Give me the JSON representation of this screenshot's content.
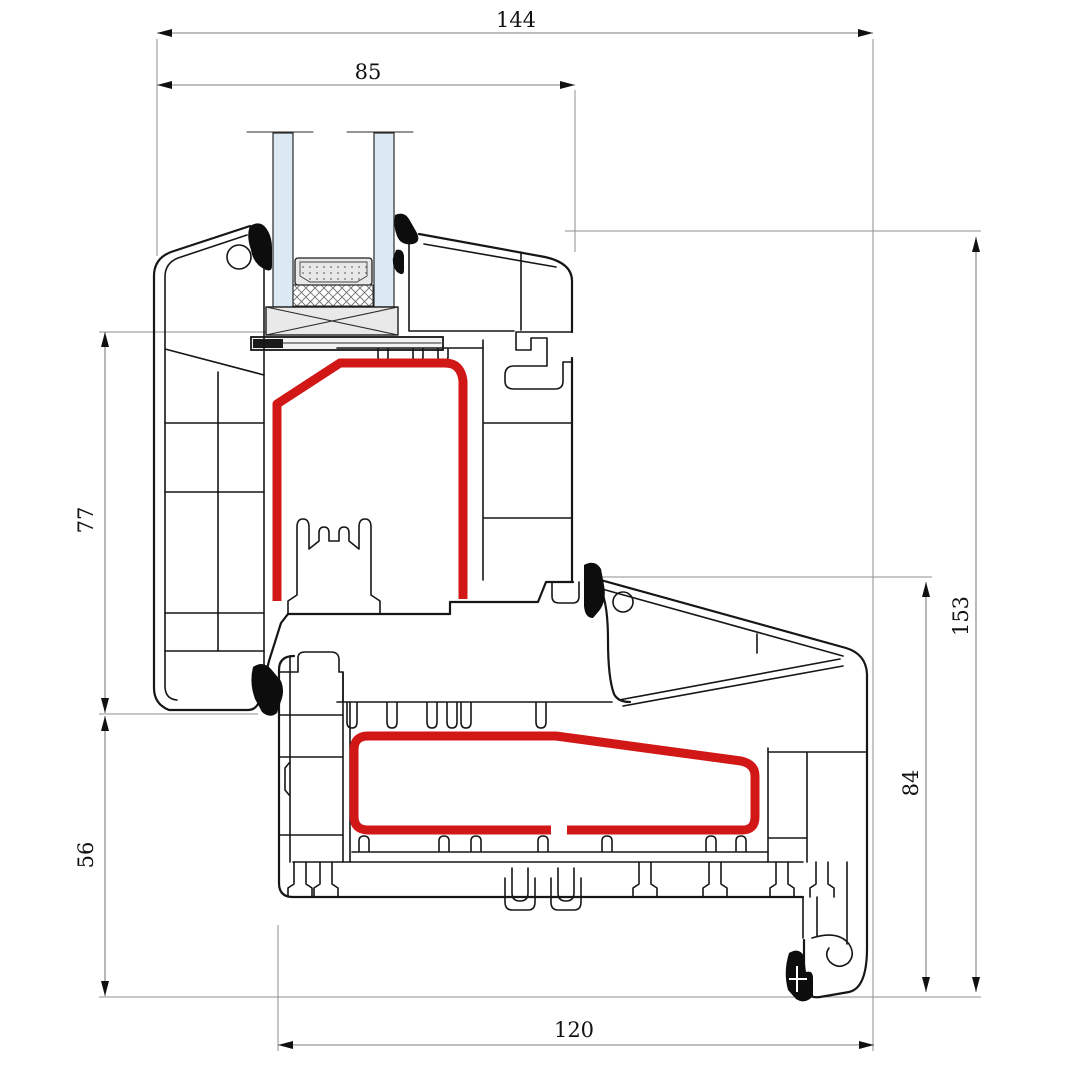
{
  "drawing": {
    "title": "PVC window sill profile cross-section with insulated glazing",
    "labels": {
      "total_width": "144",
      "glazing_unit_width": "85",
      "frame_height": "77",
      "sill_front_height": "56",
      "total_height": "153",
      "sill_back_height": "84",
      "sill_width": "120"
    },
    "colors": {
      "gasket_red": "#d21717",
      "glass_blue": "#dce9f2",
      "outline_black": "#161616",
      "dimension_gray": "#8f8f8f",
      "block_gray": "#e9e9e9"
    }
  }
}
